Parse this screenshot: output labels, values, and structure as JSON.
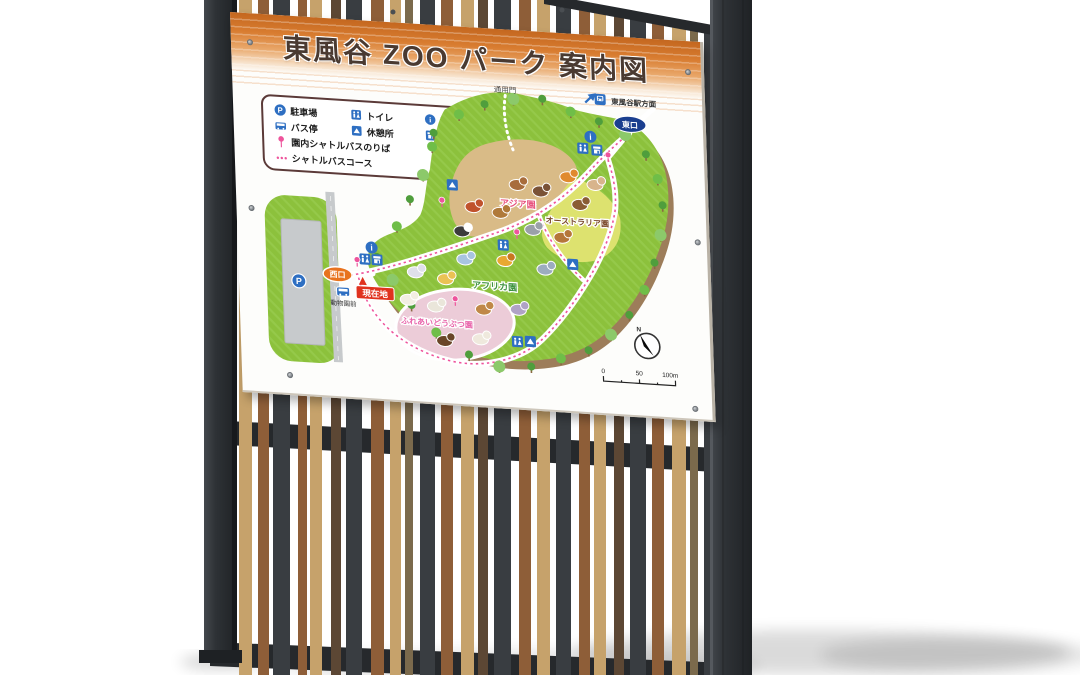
{
  "sign": {
    "title": "東風谷 ZOO パーク 案内図"
  },
  "legend": {
    "items": [
      {
        "icon": "parking-icon",
        "label": "駐車場"
      },
      {
        "icon": "toilet-icon",
        "label": "トイレ"
      },
      {
        "icon": "information-icon",
        "label": "案内所"
      },
      {
        "icon": "bus-stop-icon",
        "label": "バス停"
      },
      {
        "icon": "rest-area-icon",
        "label": "休憩所"
      },
      {
        "icon": "shop-icon",
        "label": "売店"
      },
      {
        "icon": "shuttle-bus-stop-icon",
        "label": "園内シャトルバスのりば"
      },
      {
        "icon": "shuttle-bus-course-icon",
        "label": "シャトルバスコース"
      }
    ]
  },
  "map": {
    "labels": {
      "service_gate": "通用門",
      "station_direction": "東風谷駅方面",
      "east_gate": "東口",
      "west_gate": "西口",
      "current_location": "現在地",
      "bus_stop_name": "動物園前",
      "compass_north": "N"
    },
    "zones": [
      {
        "id": "asia",
        "label": "アジア園",
        "color": "#d9bb87",
        "label_color": "#e8527e"
      },
      {
        "id": "australia",
        "label": "オーストラリア園",
        "color": "#dde26f",
        "label_color": "#7b4a2b"
      },
      {
        "id": "africa",
        "label": "アフリカ園",
        "color": "#8cc13c",
        "label_color": "#3f9340"
      },
      {
        "id": "petting",
        "label": "ふれあいどうぶつ園",
        "color": "#ecccd8",
        "label_color": "#e864aa"
      }
    ],
    "scale": {
      "ticks": [
        "0",
        "50",
        "100m"
      ]
    },
    "animals": [
      {
        "n": "monkey",
        "x": 282,
        "y": 99,
        "c": "#a86c3c"
      },
      {
        "n": "tanuki",
        "x": 305,
        "y": 104,
        "c": "#7a5236"
      },
      {
        "n": "fox",
        "x": 333,
        "y": 88,
        "c": "#e08a2e"
      },
      {
        "n": "red-panda",
        "x": 237,
        "y": 124,
        "c": "#c0522c"
      },
      {
        "n": "deer",
        "x": 264,
        "y": 128,
        "c": "#b07a3a"
      },
      {
        "n": "panda",
        "x": 225,
        "y": 149,
        "c": "#3c3c3c",
        "c2": "#ffffff"
      },
      {
        "n": "rabbit",
        "x": 360,
        "y": 94,
        "c": "#d8b48c"
      },
      {
        "n": "hedgehog",
        "x": 344,
        "y": 115,
        "c": "#8a5c34"
      },
      {
        "n": "koala",
        "x": 296,
        "y": 143,
        "c": "#9aa0a8"
      },
      {
        "n": "kangaroo",
        "x": 325,
        "y": 149,
        "c": "#b5763a"
      },
      {
        "n": "elephant",
        "x": 227,
        "y": 177,
        "c": "#a8c4e0"
      },
      {
        "n": "lion",
        "x": 267,
        "y": 176,
        "c": "#e8a832",
        "c2": "#c87820"
      },
      {
        "n": "rhino",
        "x": 307,
        "y": 182,
        "c": "#9cacbe"
      },
      {
        "n": "zebra",
        "x": 177,
        "y": 193,
        "c": "#e0e0ea"
      },
      {
        "n": "giraffe",
        "x": 207,
        "y": 198,
        "c": "#eac254"
      },
      {
        "n": "hippo",
        "x": 279,
        "y": 224,
        "c": "#b0a2c6"
      },
      {
        "n": "sheep",
        "x": 169,
        "y": 221,
        "c": "#f2eee2"
      },
      {
        "n": "goat",
        "x": 196,
        "y": 226,
        "c": "#eae6da"
      },
      {
        "n": "fawn",
        "x": 244,
        "y": 226,
        "c": "#c08848"
      },
      {
        "n": "horse",
        "x": 204,
        "y": 260,
        "c": "#6a4628"
      },
      {
        "n": "alpaca",
        "x": 240,
        "y": 256,
        "c": "#efe9dd"
      }
    ],
    "facility_icons": [
      {
        "t": "parking",
        "x": 60,
        "y": 209
      },
      {
        "t": "bus",
        "x": 104,
        "y": 217
      },
      {
        "t": "info",
        "x": 134,
        "y": 171
      },
      {
        "t": "toilet",
        "x": 127,
        "y": 183
      },
      {
        "t": "shop",
        "x": 139,
        "y": 183
      },
      {
        "t": "rest",
        "x": 217,
        "y": 103
      },
      {
        "t": "toilet",
        "x": 266,
        "y": 160
      },
      {
        "t": "rest",
        "x": 335,
        "y": 175
      },
      {
        "t": "info",
        "x": 357,
        "y": 46
      },
      {
        "t": "toilet",
        "x": 349,
        "y": 58
      },
      {
        "t": "shop",
        "x": 363,
        "y": 59
      },
      {
        "t": "station",
        "x": 368,
        "y": 8
      },
      {
        "t": "toilet",
        "x": 277,
        "y": 256
      },
      {
        "t": "rest",
        "x": 290,
        "y": 255
      }
    ],
    "shuttle_stops": [
      [
        374,
        66
      ],
      [
        206,
        122
      ],
      [
        280,
        149
      ],
      [
        119,
        187
      ],
      [
        216,
        220
      ]
    ],
    "trees": [
      [
        200,
        52,
        0
      ],
      [
        226,
        32,
        1
      ],
      [
        252,
        20,
        0
      ],
      [
        281,
        13,
        2
      ],
      [
        310,
        11,
        0
      ],
      [
        338,
        22,
        1
      ],
      [
        366,
        30,
        0
      ],
      [
        392,
        42,
        2
      ],
      [
        412,
        60,
        0
      ],
      [
        423,
        84,
        1
      ],
      [
        427,
        110,
        0
      ],
      [
        424,
        140,
        2
      ],
      [
        417,
        168,
        0
      ],
      [
        406,
        196,
        1
      ],
      [
        390,
        222,
        0
      ],
      [
        371,
        243,
        2
      ],
      [
        348,
        260,
        0
      ],
      [
        320,
        270,
        1
      ],
      [
        290,
        280,
        0
      ],
      [
        258,
        282,
        2
      ],
      [
        228,
        272,
        0
      ],
      [
        196,
        252,
        1
      ],
      [
        172,
        226,
        0
      ],
      [
        154,
        202,
        2
      ],
      [
        139,
        180,
        0
      ],
      [
        160,
        148,
        1
      ],
      [
        174,
        120,
        0
      ],
      [
        188,
        95,
        2
      ],
      [
        198,
        66,
        1
      ]
    ]
  },
  "colors": {
    "band_orange": "#d87c30",
    "map_green": "#8cc13c",
    "path_white": "#ffffff",
    "shuttle_pink": "#ee549c",
    "icon_blue": "#2e6fc2",
    "east_gate_navy": "#1b3f8f",
    "west_gate_orange": "#e8731e",
    "current_location_red": "#e0321e",
    "dirt_brown": "#9d7d5a",
    "road_gray": "#c7cacc",
    "fence_palette": [
      "#c6a26b",
      "#8e5e38",
      "#393d41",
      "#5c4734",
      "#7b6a4c"
    ],
    "fence_frame": "#26292c"
  },
  "fence": {
    "slats": [
      {
        "p": 0,
        "w": 13,
        "g": 6
      },
      {
        "p": 1,
        "w": 11,
        "g": 4
      },
      {
        "p": 2,
        "w": 17,
        "g": 8
      },
      {
        "p": 1,
        "w": 9,
        "g": 3
      },
      {
        "p": 0,
        "w": 12,
        "g": 9
      },
      {
        "p": 3,
        "w": 10,
        "g": 5
      },
      {
        "p": 2,
        "w": 16,
        "g": 9
      },
      {
        "p": 1,
        "w": 13,
        "g": 6
      },
      {
        "p": 0,
        "w": 11,
        "g": 4
      },
      {
        "p": 4,
        "w": 8,
        "g": 7
      },
      {
        "p": 2,
        "w": 15,
        "g": 6
      },
      {
        "p": 1,
        "w": 12,
        "g": 8
      },
      {
        "p": 0,
        "w": 13,
        "g": 4
      },
      {
        "p": 3,
        "w": 10,
        "g": 6
      },
      {
        "p": 2,
        "w": 17,
        "g": 8
      },
      {
        "p": 1,
        "w": 12,
        "g": 6
      },
      {
        "p": 0,
        "w": 13,
        "g": 6
      },
      {
        "p": 2,
        "w": 15,
        "g": 8
      },
      {
        "p": 1,
        "w": 11,
        "g": 4
      },
      {
        "p": 0,
        "w": 12,
        "g": 8
      },
      {
        "p": 3,
        "w": 10,
        "g": 6
      },
      {
        "p": 2,
        "w": 16,
        "g": 6
      },
      {
        "p": 1,
        "w": 12,
        "g": 8
      },
      {
        "p": 0,
        "w": 14,
        "g": 4
      },
      {
        "p": 4,
        "w": 8,
        "g": 6
      },
      {
        "p": 2,
        "w": 15,
        "g": 6
      }
    ]
  }
}
